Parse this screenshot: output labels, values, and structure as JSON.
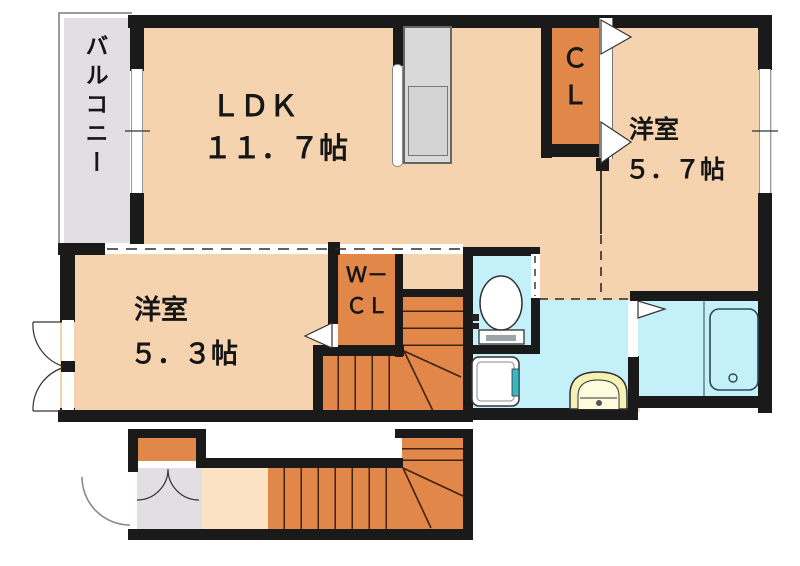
{
  "colors": {
    "wall": "#1a1a1a",
    "floor_peach": "#f6d3af",
    "hall_peach": "#fae2c2",
    "closet_orange": "#e1874a",
    "wet_cyan": "#c4f0fa",
    "balcony_gray": "#e2dee2",
    "kitchen_gray": "#d9d9d9",
    "basin_yellow": "#f6f0b4",
    "teal_accent": "#35b8c0",
    "stair_line": "#42210a",
    "outline": "#333333"
  },
  "rooms": {
    "balcony": {
      "label": "バルコニー"
    },
    "ldk": {
      "name": "ＬＤＫ",
      "size": "１１．７帖"
    },
    "closet": {
      "line1": "Ｃ",
      "line2": "Ｌ"
    },
    "bedroom_5_7": {
      "name": "洋室",
      "size": "５．７帖"
    },
    "walk_in_closet": {
      "line1": "Ｗ－",
      "line2": "ＣＬ"
    },
    "bedroom_5_3": {
      "name": "洋室",
      "size": "５．３帖"
    }
  },
  "fixtures": {
    "kitchen": "kitchen-counter-with-sink",
    "toilet": "toilet",
    "washer_pan": "washing-machine-pan",
    "washbasin": "washbasin",
    "bathtub": "bathtub",
    "stairs_second_floor": "l-shaped-staircase",
    "stairs_entrance": "entrance-staircase"
  }
}
